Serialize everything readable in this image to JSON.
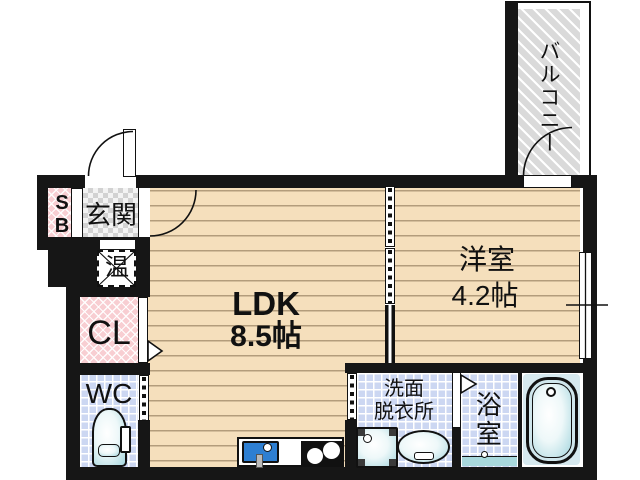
{
  "plan": {
    "balcony": "バルコニー",
    "western_room": {
      "name": "洋室",
      "area": "4.2帖"
    },
    "ldk": {
      "name": "LDK",
      "area": "8.5帖"
    },
    "entrance": "玄関",
    "shoe_box": "SB",
    "water_heater": "温",
    "closet": "CL",
    "toilet": "WC",
    "washroom": {
      "line1": "洗面",
      "line2": "脱衣所"
    },
    "bathroom": "浴室"
  },
  "colors": {
    "wall": "#161616",
    "wood_floor": "#f5dfbc",
    "tile_blue": "#ccd7f2",
    "closet_pink": "#f8ced2",
    "balcony_gray": "#dadada",
    "entrance_checker": "#d2d2d2",
    "fixture_teal": "#a5d6de",
    "kitchen_sink_blue": "#2e7fd2"
  }
}
